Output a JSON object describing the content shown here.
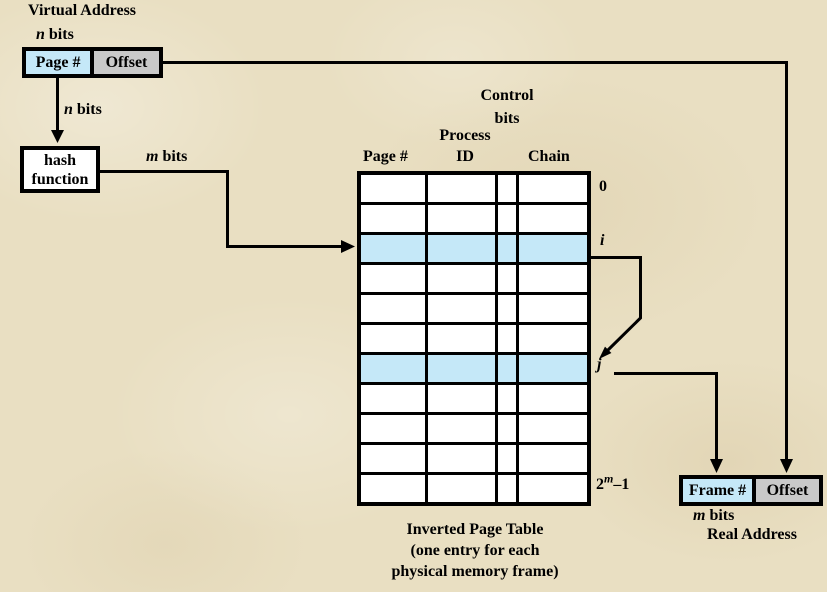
{
  "diagram": {
    "virtual_address": {
      "title": "Virtual Address",
      "n_bits_top": {
        "var": "n",
        "rest": " bits"
      },
      "page_label": "Page #",
      "offset_label": "Offset",
      "n_bits_mid": {
        "var": "n",
        "rest": " bits"
      }
    },
    "hash_function": {
      "line1": "hash",
      "line2": "function"
    },
    "m_bits": {
      "var": "m",
      "rest": " bits"
    },
    "table": {
      "headers": {
        "page": "Page #",
        "process_line1": "Process",
        "process_line2": "ID",
        "control_line1": "Control",
        "control_line2": "bits",
        "chain": "Chain"
      },
      "num_rows": 11,
      "num_cols": 4,
      "highlighted_rows": [
        2,
        6
      ],
      "row_labels": {
        "first": "0",
        "i": "i",
        "j": "j",
        "last_base": "2",
        "last_sup": "m",
        "last_rest": "–1"
      }
    },
    "caption": {
      "line1": "Inverted Page Table",
      "line2": "(one entry for each",
      "line3": "physical memory frame)"
    },
    "real_address": {
      "frame_label": "Frame #",
      "offset_label": "Offset",
      "m_bits": {
        "var": "m",
        "rest": " bits"
      },
      "title": "Real Address"
    },
    "colors": {
      "highlight_blue": "#c5e8f8",
      "offset_gray": "#c9c9c9",
      "line_black": "#000000",
      "background_parchment": "#e9dfc2"
    }
  }
}
